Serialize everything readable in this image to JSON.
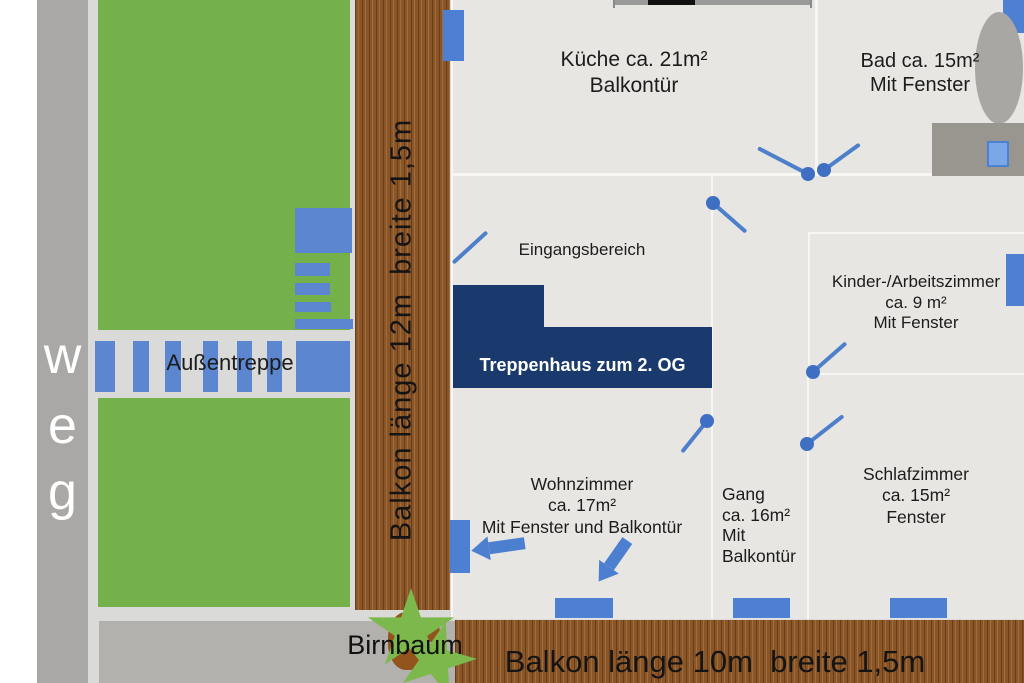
{
  "plan_title": "Wohnungs-Grundriss 1. OG",
  "colors": {
    "accent_blue": "#4d80d2",
    "stair_blue": "#5c86d0",
    "navy": "#1a3a6e",
    "garden_green": "#74b14a",
    "tree_green": "#7cb84c",
    "trunk_brown": "#93531d",
    "balcony_brown": "#8a5527",
    "path_gray": "#a9a8a6",
    "room_floor": "#e7e6e3",
    "ground_gray": "#dadad8"
  },
  "path_label": {
    "letters": [
      "w",
      "e",
      "g"
    ]
  },
  "aussentreppe": {
    "label": "Außentreppe"
  },
  "balkon_left": {
    "label": "Balkon länge 12m  breite 1,5m"
  },
  "balkon_bottom": {
    "label": "Balkon länge 10m  breite 1,5m"
  },
  "birnbaum": {
    "label": "Birnbaum"
  },
  "rooms": {
    "kueche": {
      "line1": "Küche ca. 21m²",
      "line2": "Balkontür"
    },
    "bad": {
      "line1": "Bad ca. 15m²",
      "line2": "Mit Fenster"
    },
    "eingangsbereich": {
      "line1": "Eingangsbereich"
    },
    "treppenhaus": {
      "line1": "Treppenhaus zum 2. OG"
    },
    "kinderzimmer": {
      "line1": "Kinder-/Arbeitszimmer",
      "line2": "ca. 9 m²",
      "line3": "Mit Fenster"
    },
    "wohnzimmer": {
      "line1": "Wohnzimmer",
      "line2": "ca. 17m²",
      "line3": "Mit Fenster und Balkontür"
    },
    "gang": {
      "line1": "Gang",
      "line2": "ca. 16m²",
      "line3": "Mit",
      "line4": "Balkontür"
    },
    "schlafzimmer": {
      "line1": "Schlafzimmer",
      "line2": "ca. 15m²",
      "line3": "Fenster"
    }
  }
}
